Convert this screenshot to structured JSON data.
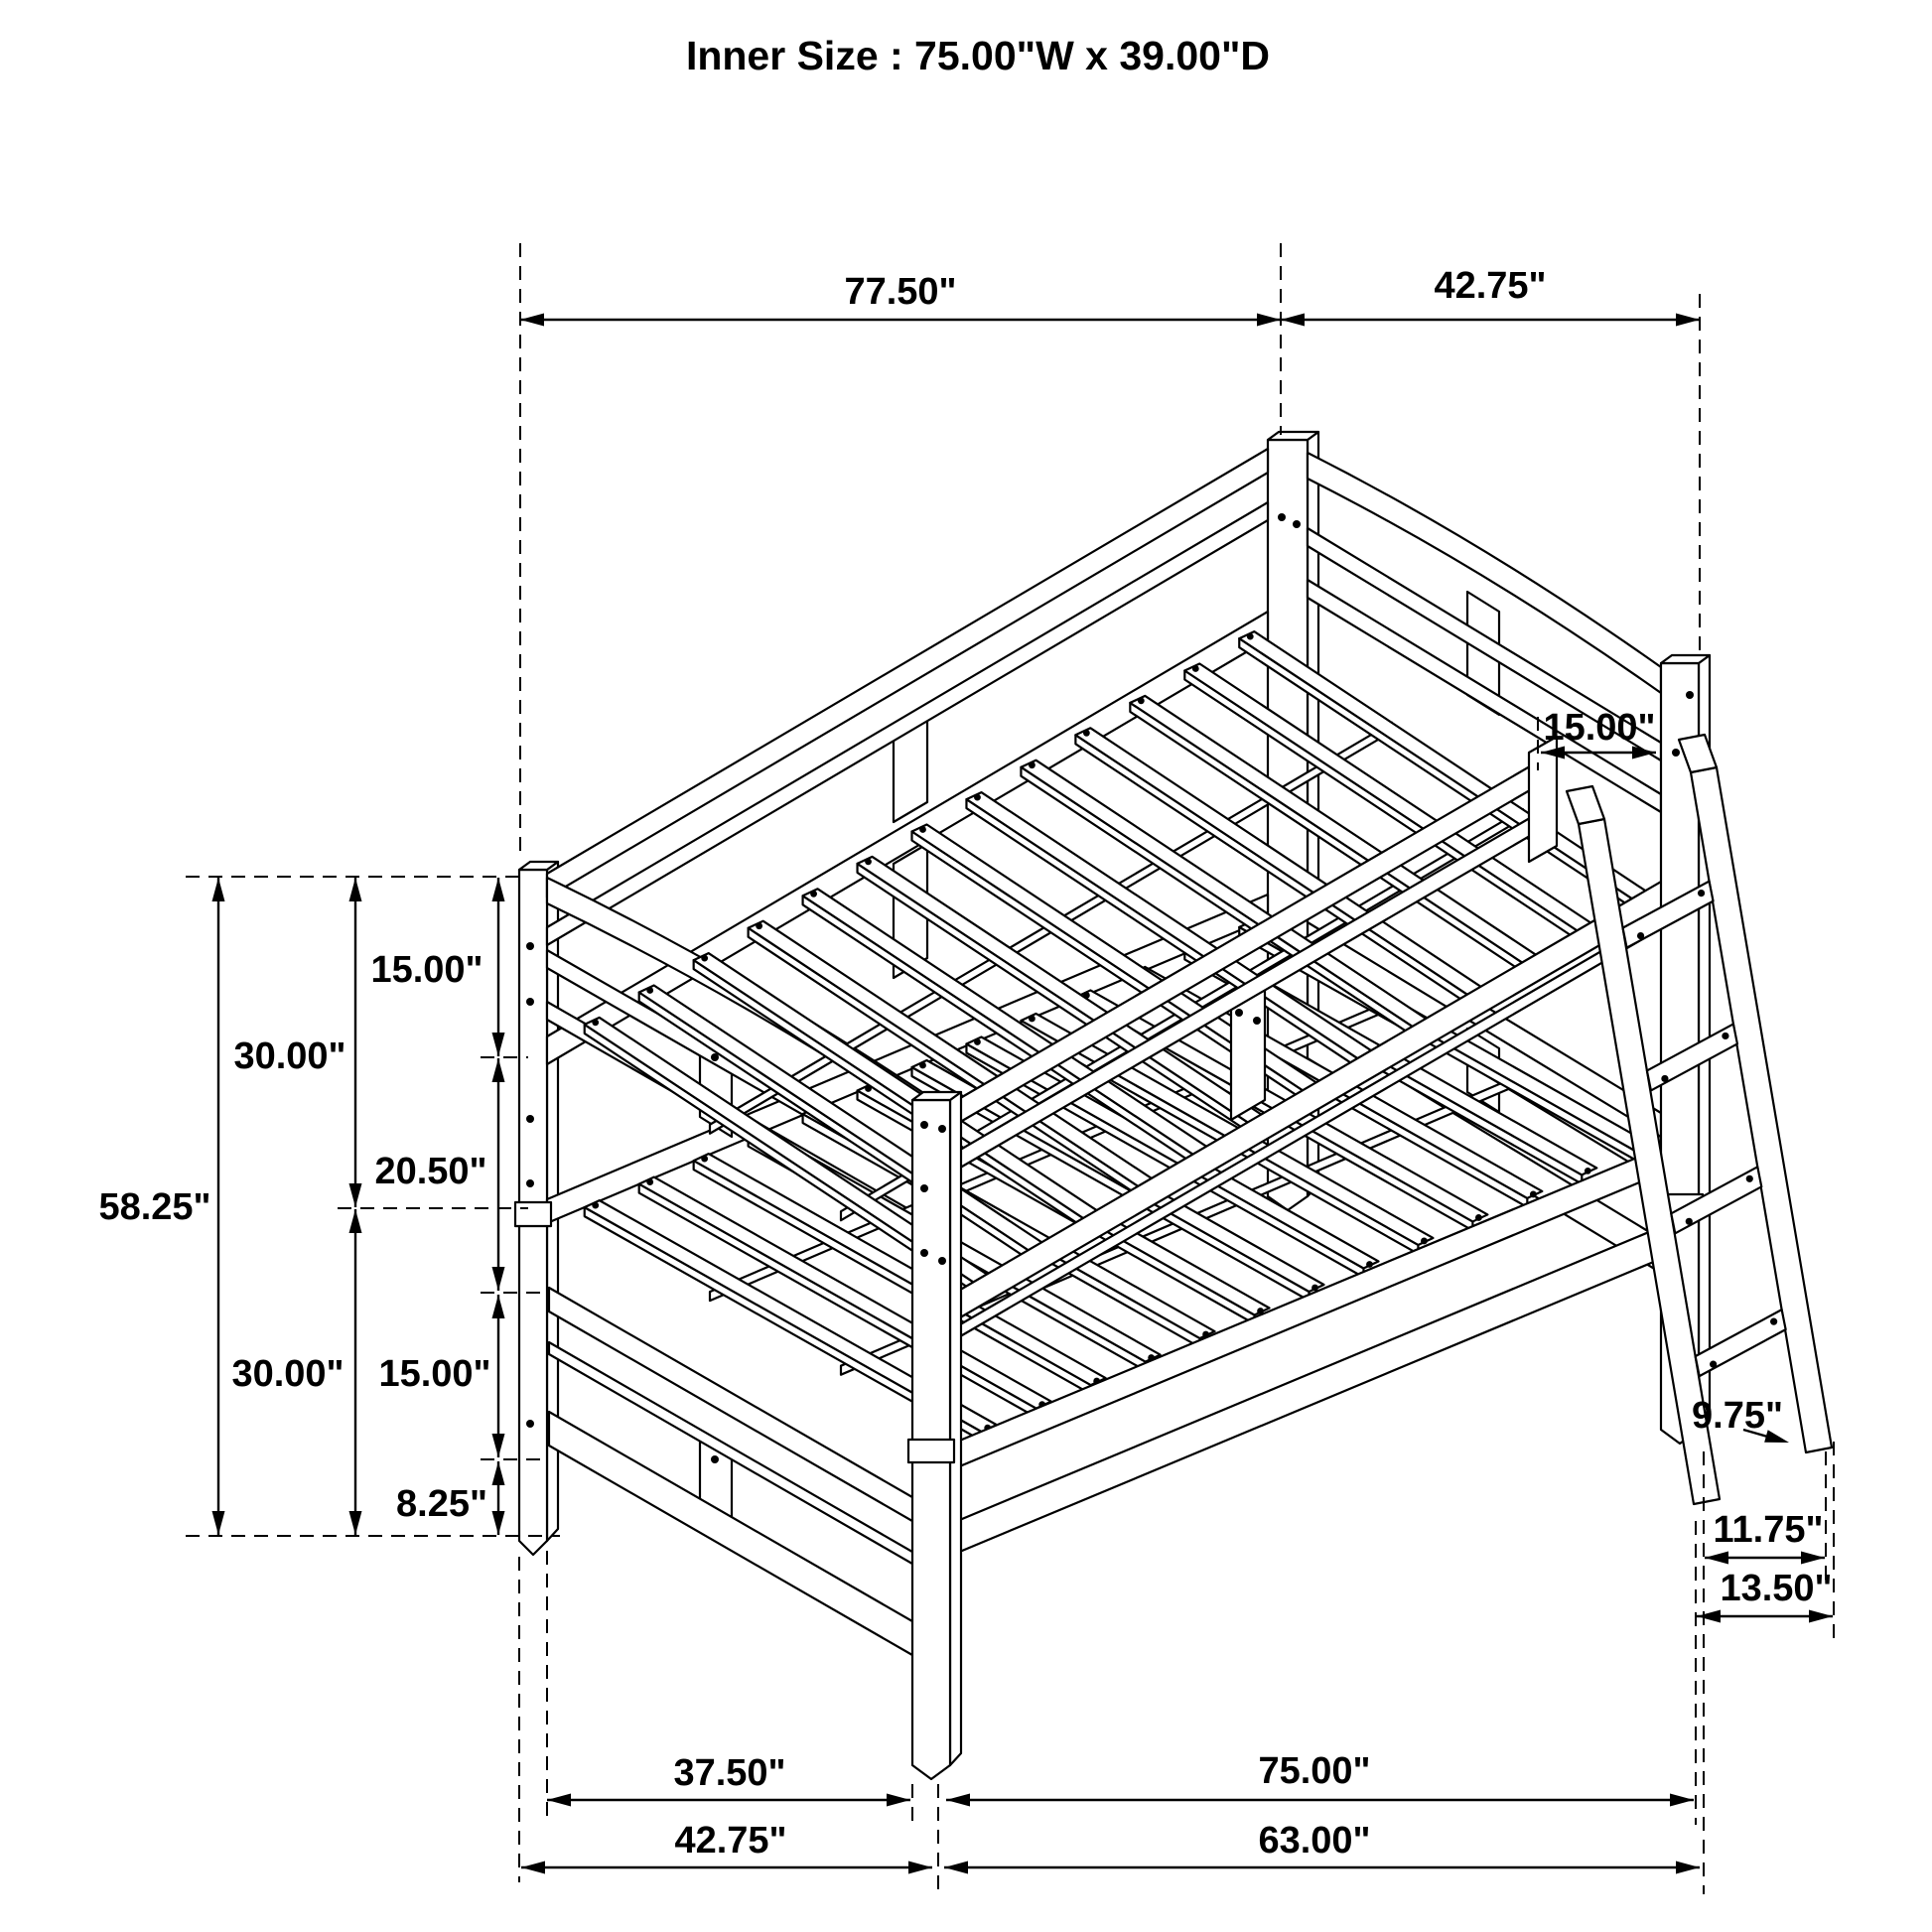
{
  "title": "Inner Size : 75.00\"W x 39.00\"D",
  "dims": {
    "top_length": "77.50\"",
    "top_depth": "42.75\"",
    "ladder_opening": "15.00\"",
    "upper_rail": "15.00\"",
    "upper_half": "30.00\"",
    "bunk_gap": "20.50\"",
    "total_height": "58.25\"",
    "lower_half": "30.00\"",
    "lower_rail": "15.00\"",
    "bottom_clearance": "8.25\"",
    "rung_spacing": "9.75\"",
    "ladder_inner": "11.75\"",
    "ladder_outer": "13.50\"",
    "bottom_inner_left": "37.50\"",
    "bottom_length_right": "75.00\"",
    "bottom_depth_left": "42.75\"",
    "bottom_inner_right": "63.00\""
  }
}
